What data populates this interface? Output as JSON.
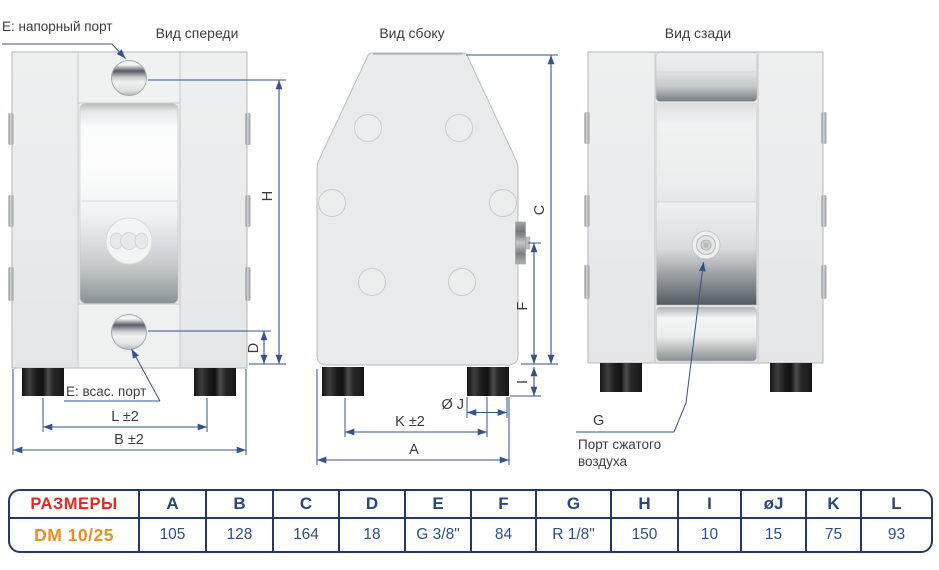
{
  "views": {
    "front": {
      "title": "Вид спереди",
      "discharge_port_label": "Е: напорный порт",
      "suction_port_label": "Е: всас. порт",
      "dim_h": "H",
      "dim_d": "D",
      "dim_l": "L ±2",
      "dim_b": "B ±2"
    },
    "side": {
      "title": "Вид сбоку",
      "dim_c": "C",
      "dim_f": "F",
      "dim_i": "I",
      "dim_j": "Ø J",
      "dim_k": "K ±2",
      "dim_a": "A"
    },
    "rear": {
      "title": "Вид сзади",
      "air_dim": "G",
      "air_port_label_line1": "Порт сжатого",
      "air_port_label_line2": "воздуха"
    }
  },
  "table": {
    "row_label": "РАЗМЕРЫ",
    "model": "DM 10/25",
    "columns": [
      {
        "header": "A",
        "value": "105"
      },
      {
        "header": "B",
        "value": "128"
      },
      {
        "header": "C",
        "value": "164"
      },
      {
        "header": "D",
        "value": "18"
      },
      {
        "header": "E",
        "value": "G 3/8\""
      },
      {
        "header": "F",
        "value": "84"
      },
      {
        "header": "G",
        "value": "R 1/8\""
      },
      {
        "header": "H",
        "value": "150"
      },
      {
        "header": "I",
        "value": "10"
      },
      {
        "header": "øJ",
        "value": "15"
      },
      {
        "header": "K",
        "value": "75"
      },
      {
        "header": "L",
        "value": "93"
      }
    ]
  },
  "colors": {
    "dimension_line": "#35518f",
    "table_border": "#22386b",
    "header_text": "#27477e",
    "value_text": "#2b4e8c",
    "row_label_text": "#e8271f",
    "model_text": "#f08c1e"
  }
}
